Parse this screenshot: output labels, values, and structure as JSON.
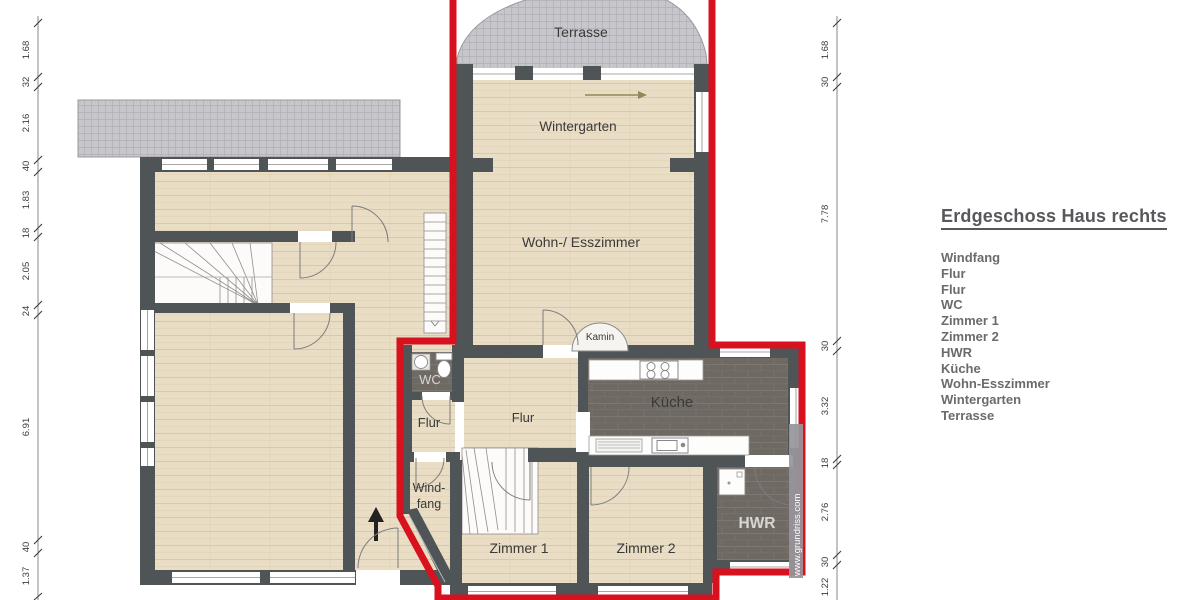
{
  "legend": {
    "title": "Erdgeschoss Haus rechts",
    "items": [
      "Windfang",
      "Flur",
      "Flur",
      "WC",
      "Zimmer 1",
      "Zimmer 2",
      "HWR",
      "Küche",
      "Wohn-Esszimmer",
      "Wintergarten",
      "Terrasse"
    ]
  },
  "rooms": {
    "terrasse": "Terrasse",
    "wintergarten": "Wintergarten",
    "wohn_esszimmer": "Wohn-/ Esszimmer",
    "kamin": "Kamin",
    "kueche": "Küche",
    "wc": "WC",
    "flur_klein": "Flur",
    "flur": "Flur",
    "windfang_line1": "Wind-",
    "windfang_line2": "fang",
    "zimmer_1": "Zimmer 1",
    "zimmer_2": "Zimmer 2",
    "hwr": "HWR"
  },
  "dimensions": {
    "left": [
      "1.68",
      "32",
      "2.16",
      "40",
      "1.83",
      "18",
      "2.05",
      "24",
      "6.91",
      "40",
      "1.37"
    ],
    "right": [
      "1.68",
      "30",
      "7.78",
      "30",
      "3.32",
      "18",
      "2.76",
      "30",
      "1.22"
    ]
  },
  "watermark": "www.grundriss.com",
  "colors": {
    "highlight": "#d8111f",
    "wall": "#4f5457",
    "wood": "#e8dcc6",
    "tile": "#6f6963",
    "terrace": "#c7c6cb"
  }
}
